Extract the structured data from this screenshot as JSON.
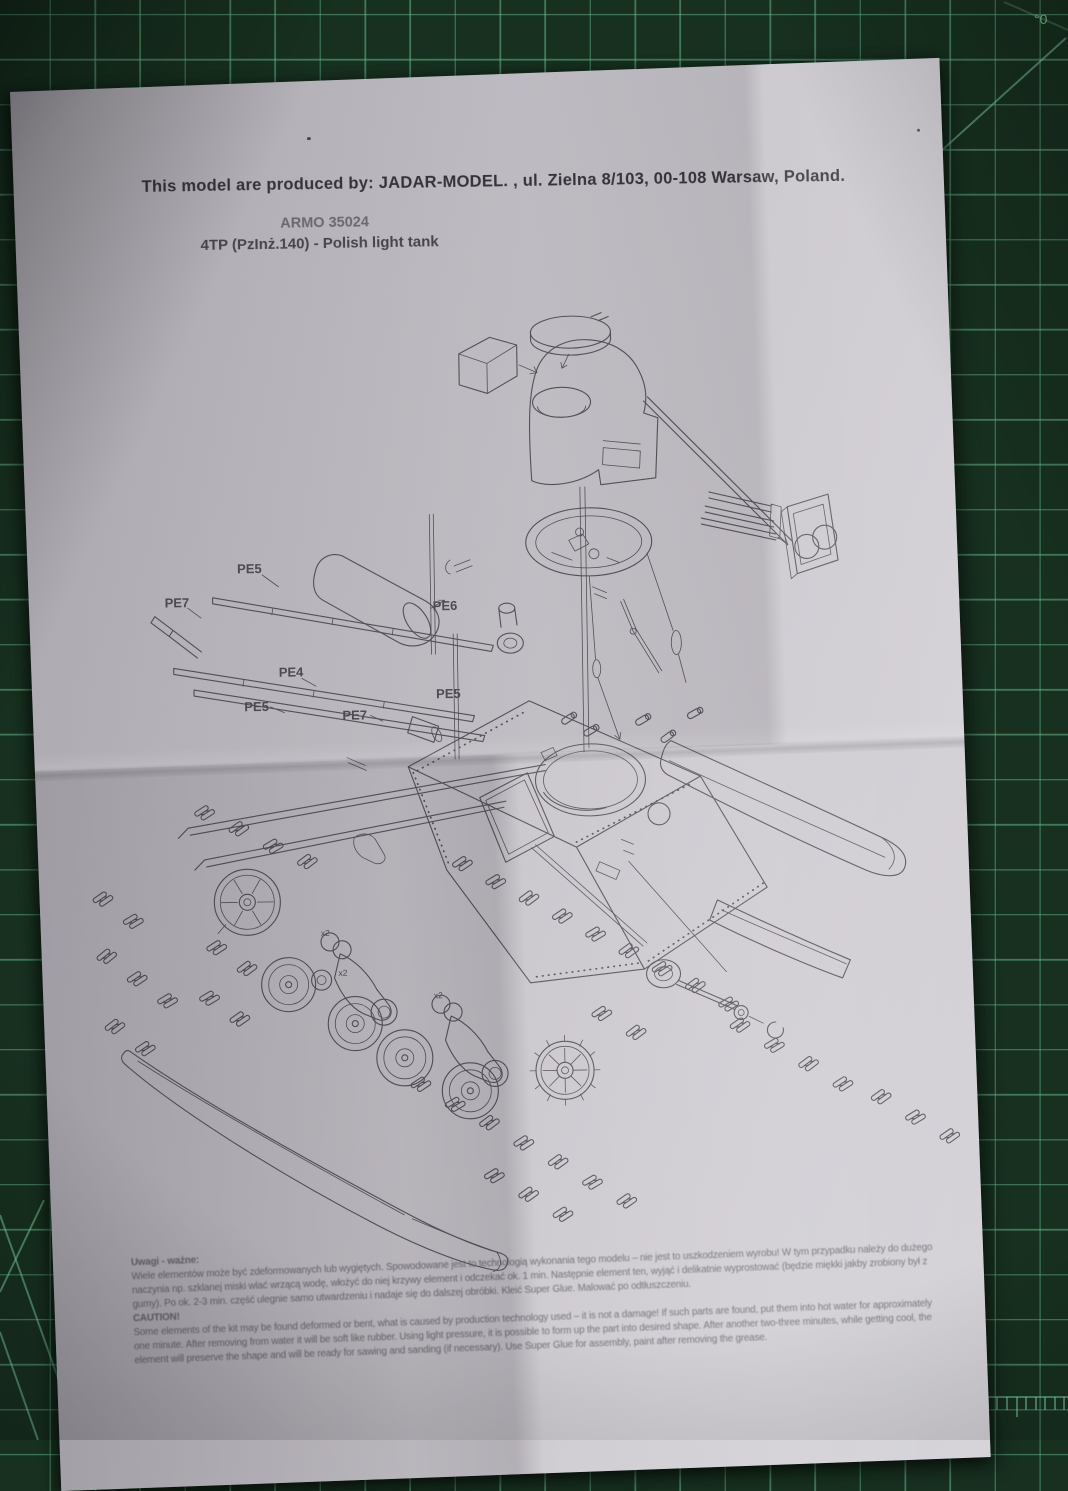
{
  "mat": {
    "corner_label": "°0",
    "base_color": "#17301f",
    "grid_color": "#62b487"
  },
  "paper": {
    "color": "#c9c6cc",
    "ink_color": "#57535c"
  },
  "header": {
    "producer_line": "This model are produced by: JADAR-MODEL. , ul. Zielna 8/103, 00-108 Warsaw, Poland.",
    "kit_number": "ARMO 35024",
    "kit_name": "4TP (PzInż.140) - Polish light tank"
  },
  "diagram": {
    "part_labels": [
      "PE5",
      "PE7",
      "PE6",
      "PE4",
      "PE5",
      "PE7",
      "PE5"
    ],
    "quantity_labels": [
      "x2",
      "x2",
      "x2"
    ]
  },
  "footer": {
    "pl_heading": "Uwagi - ważne:",
    "pl_lines": [
      "Wiele elementów może być zdeformowanych lub wygiętych. Spowodowane jest to technologią wykonania tego modelu – nie jest to uszkodzeniem wyrobu! W tym przypadku należy do dużego",
      "naczynia np. szklanej miski wlać wrzącą wodę, włożyć do niej krzywy element i odczekać ok. 1 min. Następnie element ten, wyjąć i delikatnie wyprostować (będzie miękki jakby zrobiony był z",
      "gumy). Po ok. 2-3 min. część ulegnie samo utwardzeniu i nadaje się do dalszej obróbki. Kleić Super Glue. Malować po odtłuszczeniu."
    ],
    "en_heading": "CAUTION!",
    "en_lines": [
      "Some elements of the kit may be found deformed or bent, what is caused by production technology used – it is not a damage! If such parts are found, put them into hot water for approximately",
      "one minute. After removing from water it will be soft like rubber. Using light pressure, it is possible to form up the part into desired shape. After another two-three minutes, while getting cool, the",
      "element will preserve the shape and will be ready for sawing and sanding (if necessary). Use Super Glue for assembly, paint after removing the grease."
    ]
  }
}
